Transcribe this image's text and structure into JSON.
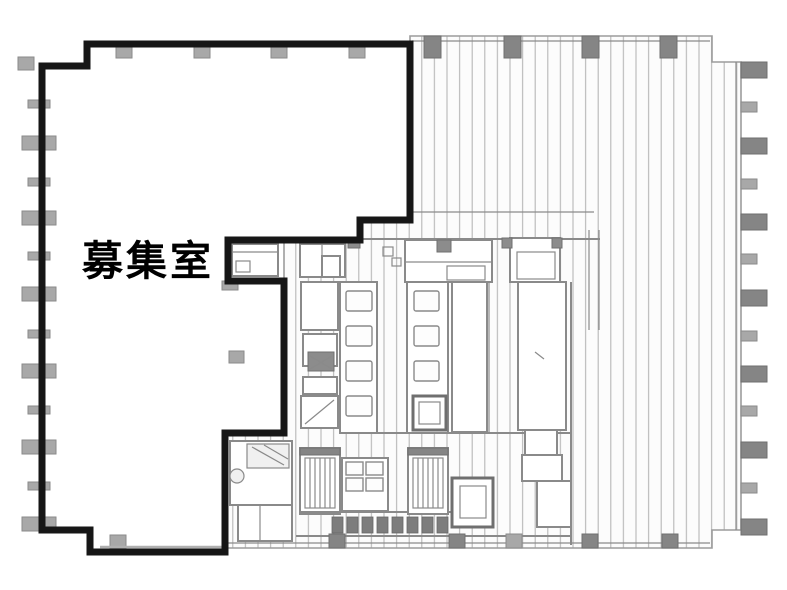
{
  "plan": {
    "available_room_label": "募集室",
    "colors": {
      "background": "#ffffff",
      "boundary": "#161616",
      "wall": "#8a8a8a",
      "wall_dark": "#6f6f6f",
      "column": "#a8a8a8",
      "column_dark": "#858585",
      "hatch_line": "#b7b7b7",
      "room_fill": "#ffffff",
      "label_color": "#000000"
    }
  }
}
